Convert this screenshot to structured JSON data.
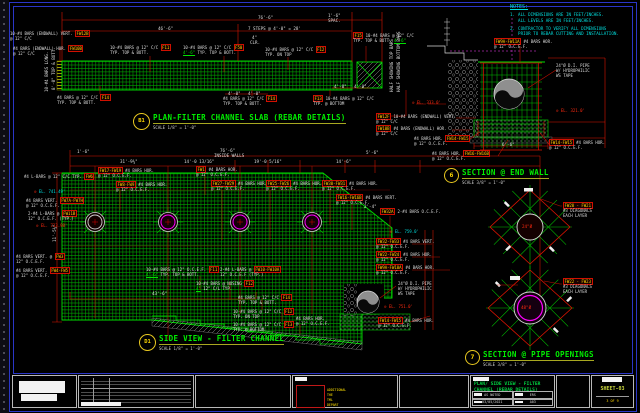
{
  "colors": {
    "dim_red": "#dd1400",
    "rebar_green": "#00b400",
    "title_green": "#00ef00",
    "note_cyan": "#00dcdc",
    "tag_yellow": "#ffd700",
    "pipe_magenta": "#ff30ff",
    "frame_blue": "#2a36c8"
  },
  "notes": {
    "title": "NOTES:",
    "items": [
      {
        "num": "1.",
        "lines": [
          "ALL DIMENSIONS ARE IN FEET/INCHES.",
          "ALL LEVELS ARE IN FEET/INCHES."
        ]
      },
      {
        "num": "2.",
        "lines": [
          "CONTRACTOR TO VERIFY ALL DIMENSIONS",
          "PRIOR TO REBAR CUTTING AND INSTALLATION."
        ]
      }
    ]
  },
  "views": {
    "plan": {
      "bubble": "B1",
      "title": "PLAN-FILTER CHANNEL SLAB (REBAR DETAILS)",
      "scale": "SCALE 1/8\" = 1'-0\""
    },
    "side": {
      "bubble": "D1",
      "title": "SIDE VIEW - FILTER CHANNEL",
      "scale": "SCALE 1/8\" = 1'-0\""
    },
    "end_wall": {
      "bubble": "6",
      "title": "SECTION @ END WALL",
      "scale": "SCALE 3/8\" = 1'-0\""
    },
    "pipe_openings": {
      "bubble": "7",
      "title": "SECTION @ PIPE OPENINGS",
      "scale": "SCALE 3/8\" = 1'-0\""
    }
  },
  "titleblock": {
    "drawing_title_line1": "PLAN/ SIDE VIEW - FILTER",
    "drawing_title_line2": "CHANNEL (REBAR DETAILS)",
    "scale": "AS NOTED",
    "drawn_by": "ERS",
    "date": "03/05/2021",
    "dwg_no": "A03",
    "sheet_label": "SHEET-03",
    "sheet_count": "3 OF 9",
    "stamp_lines": [
      "ADDITIONAL",
      "THE",
      "TML",
      "DEPART"
    ]
  },
  "callouts": [
    {
      "x": 10,
      "y": 31,
      "lines": [
        [
          {
            "t": "10-#4 BARS (ENDWALL) VERT. "
          },
          {
            "t": "FW12B",
            "c": "y"
          }
        ],
        [
          {
            "t": "   @ 12\" C/C"
          }
        ]
      ]
    },
    {
      "x": 13,
      "y": 46,
      "lines": [
        [
          {
            "t": "#4 BARS (ENDWALL) HOR. "
          },
          {
            "t": "FW10B",
            "c": "y"
          }
        ],
        [
          {
            "t": "   @ 12\" C/C"
          }
        ]
      ]
    },
    {
      "x": 110,
      "y": 45,
      "lines": [
        [
          {
            "t": "10-#4 BARS @ 12\" C/C "
          },
          {
            "t": "F11",
            "c": "y"
          }
        ],
        [
          {
            "t": "TYP. TOP & BOTT."
          }
        ]
      ]
    },
    {
      "x": 183,
      "y": 45,
      "lines": [
        [
          {
            "t": "10-#4 BARS @ 12\" C/C "
          },
          {
            "t": "F50",
            "c": "y"
          }
        ],
        [
          {
            "t": "4'-6\"",
            "c": "g"
          },
          {
            "t": " TYP. TOP & BOTT."
          }
        ]
      ]
    },
    {
      "x": 265,
      "y": 47,
      "lines": [
        [
          {
            "t": "10-#4 BARS @ 12\" C/C "
          },
          {
            "t": "F12",
            "c": "y"
          }
        ],
        [
          {
            "t": "TYP. ON TOP"
          }
        ]
      ]
    },
    {
      "x": 353,
      "y": 33,
      "lines": [
        [
          {
            "t": "F15",
            "c": "y"
          },
          {
            "t": " 10-#4 BARS @ 12\" C/C"
          }
        ],
        [
          {
            "t": "TYP. TOP & BOTT. "
          },
          {
            "t": "4'-6\"",
            "c": "g"
          }
        ]
      ]
    },
    {
      "x": 57,
      "y": 95,
      "lines": [
        [
          {
            "t": "#4 BARS @ 12\" C/C "
          },
          {
            "t": "F14",
            "c": "y"
          }
        ],
        [
          {
            "t": "TYP. TOP & BOTT."
          }
        ]
      ]
    },
    {
      "x": 223,
      "y": 96,
      "lines": [
        [
          {
            "t": "#4 BARS @ 12\" C/C "
          },
          {
            "t": "F14",
            "c": "y"
          }
        ],
        [
          {
            "t": "TYP. TOP & BOTT."
          }
        ]
      ]
    },
    {
      "x": 313,
      "y": 96,
      "lines": [
        [
          {
            "t": "F13",
            "c": "y"
          },
          {
            "t": " 10-#4 BARS @ 12\" C/C"
          }
        ],
        [
          {
            "t": "TYP. @ BOTTOM"
          }
        ]
      ]
    },
    {
      "x": 494,
      "y": 39,
      "lines": [
        [
          {
            "t": "FW9A-FW11A",
            "c": "y"
          },
          {
            "t": " #4 BARS HOR."
          }
        ],
        [
          {
            "t": "   @ 12\" O.C.E.F."
          }
        ]
      ]
    },
    {
      "x": 556,
      "y": 63,
      "lines": [
        [
          {
            "t": "24\"Ø D.I. PIPE"
          }
        ],
        [
          {
            "t": "W/ HYDROPHILIC"
          }
        ],
        [
          {
            "t": "WS TAPE"
          }
        ]
      ]
    },
    {
      "x": 412,
      "y": 100,
      "lines": [
        [
          {
            "t": "⊙ ",
            "c": "r"
          },
          {
            "t": "EL. 333.0'",
            "c": "r"
          }
        ]
      ]
    },
    {
      "x": 556,
      "y": 108,
      "lines": [
        [
          {
            "t": "⊙ ",
            "c": "r"
          },
          {
            "t": "EL. 321.0'",
            "c": "r"
          }
        ]
      ]
    },
    {
      "x": 376,
      "y": 114,
      "lines": [
        [
          {
            "t": "FW12F",
            "c": "y"
          },
          {
            "t": " 10-#4 BARS (ENDWALL) VERT."
          }
        ],
        [
          {
            "t": "   @ 12\" C/C"
          }
        ]
      ]
    },
    {
      "x": 376,
      "y": 126,
      "lines": [
        [
          {
            "t": "FW10B",
            "c": "y"
          },
          {
            "t": " #4 BARS (ENDWALL) HOR."
          }
        ],
        [
          {
            "t": "   @ 12\" C/C"
          }
        ]
      ]
    },
    {
      "x": 414,
      "y": 136,
      "lines": [
        [
          {
            "t": "#4 BARS HOR. "
          },
          {
            "t": "FW14-FW15",
            "c": "y"
          }
        ],
        [
          {
            "t": "@ 12\" O.C.E.F."
          }
        ]
      ]
    },
    {
      "x": 432,
      "y": 151,
      "lines": [
        [
          {
            "t": "#4 BARS HOR. "
          },
          {
            "t": "FW16-FW16B",
            "c": "y"
          }
        ],
        [
          {
            "t": "@ 12\" O.C.E.F."
          }
        ]
      ]
    },
    {
      "x": 549,
      "y": 140,
      "lines": [
        [
          {
            "t": "FW14-FW15",
            "c": "y"
          },
          {
            "t": " #4 BARS HOR."
          }
        ],
        [
          {
            "t": "   @ 12\" O.C.E.F."
          }
        ]
      ]
    },
    {
      "x": 24,
      "y": 174,
      "lines": [
        [
          {
            "t": "#4 L-BARS @ 12\" C/C TYP. "
          },
          {
            "t": "FW6",
            "c": "y"
          }
        ]
      ]
    },
    {
      "x": 34,
      "y": 189,
      "lines": [
        [
          {
            "t": "⊙",
            "c": "r"
          },
          {
            "t": " EL. 741.49'",
            "c": "c"
          }
        ]
      ]
    },
    {
      "x": 26,
      "y": 198,
      "lines": [
        [
          {
            "t": "#4 BARS VERT. "
          },
          {
            "t": "FW7A-FW7H",
            "c": "y"
          }
        ],
        [
          {
            "t": "@ 12\" O.C.E.F."
          }
        ]
      ]
    },
    {
      "x": 28,
      "y": 211,
      "lines": [
        [
          {
            "t": "2-#4 L-BARS @ "
          },
          {
            "t": "FW11B",
            "c": "y"
          }
        ],
        [
          {
            "t": "12\" O.C.E.F. (TYP.)"
          }
        ]
      ]
    },
    {
      "x": 36,
      "y": 223,
      "lines": [
        [
          {
            "t": "⊙",
            "c": "r"
          },
          {
            "t": " EL. 733.98'",
            "c": "r"
          }
        ]
      ]
    },
    {
      "x": 16,
      "y": 254,
      "lines": [
        [
          {
            "t": "#4 BARS VERT. @ "
          },
          {
            "t": "FW3",
            "c": "y"
          }
        ],
        [
          {
            "t": "12\" O.C.E.F."
          }
        ]
      ]
    },
    {
      "x": 16,
      "y": 268,
      "lines": [
        [
          {
            "t": "#4 BARS VERT. "
          },
          {
            "t": "FW4-FW5",
            "c": "y"
          }
        ],
        [
          {
            "t": "@ 12\" O.C.E.F."
          }
        ]
      ]
    },
    {
      "x": 98,
      "y": 168,
      "lines": [
        [
          {
            "t": "FW17-FW19",
            "c": "y"
          },
          {
            "t": " #4 BARS HOR."
          }
        ],
        [
          {
            "t": "   @ 12\" O.C.E.F."
          }
        ]
      ]
    },
    {
      "x": 116,
      "y": 182,
      "lines": [
        [
          {
            "t": "FW8-FW9",
            "c": "y"
          },
          {
            "t": " #4 BARS HOR."
          }
        ],
        [
          {
            "t": "   @ 12\" O.C.E.F."
          }
        ]
      ]
    },
    {
      "x": 196,
      "y": 167,
      "lines": [
        [
          {
            "t": "FW1",
            "c": "y"
          },
          {
            "t": " #4 BARS HOR."
          }
        ],
        [
          {
            "t": "   @ 12\" O.C.E.F."
          }
        ]
      ]
    },
    {
      "x": 211,
      "y": 181,
      "lines": [
        [
          {
            "t": "FW27-FW29",
            "c": "y"
          },
          {
            "t": " #4 BARS HOR."
          }
        ],
        [
          {
            "t": "   @ 12\" O.C.E.F."
          }
        ]
      ]
    },
    {
      "x": 266,
      "y": 181,
      "lines": [
        [
          {
            "t": "FW25-FW26",
            "c": "y"
          },
          {
            "t": " #4 BARS HOR."
          }
        ],
        [
          {
            "t": "   @ 12\" O.C.E.F."
          }
        ]
      ]
    },
    {
      "x": 322,
      "y": 181,
      "lines": [
        [
          {
            "t": "FW30-FW31",
            "c": "y"
          },
          {
            "t": " #4 BARS HOR."
          }
        ],
        [
          {
            "t": "   @ 12\" O.C.E.F."
          }
        ]
      ]
    },
    {
      "x": 336,
      "y": 195,
      "lines": [
        [
          {
            "t": "FW16-FW16B",
            "c": "y"
          },
          {
            "t": " #4 BARS VERT."
          }
        ],
        [
          {
            "t": "   @ 12\" O.C.E.F."
          }
        ]
      ]
    },
    {
      "x": 380,
      "y": 209,
      "lines": [
        [
          {
            "t": "FW32A",
            "c": "y"
          },
          {
            "t": " 2-#4 BARS O.C.E.F."
          }
        ]
      ]
    },
    {
      "x": 390,
      "y": 229,
      "lines": [
        [
          {
            "t": "⊙",
            "c": "r"
          },
          {
            "t": " EL. 759.0'",
            "c": "c"
          }
        ]
      ]
    },
    {
      "x": 376,
      "y": 239,
      "lines": [
        [
          {
            "t": "FW32-FW33",
            "c": "y"
          },
          {
            "t": " #4 BARS VERT."
          }
        ],
        [
          {
            "t": "   @ 12\" O.C.E.F."
          }
        ]
      ]
    },
    {
      "x": 376,
      "y": 252,
      "lines": [
        [
          {
            "t": "FW22-FW24",
            "c": "y"
          },
          {
            "t": " #4 BARS HOR."
          }
        ],
        [
          {
            "t": "   @ 12\" O.C.E.F."
          }
        ]
      ]
    },
    {
      "x": 376,
      "y": 265,
      "lines": [
        [
          {
            "t": "FW9A-FW10A",
            "c": "y"
          },
          {
            "t": " #4 BARS HOR."
          }
        ],
        [
          {
            "t": "   @ 12\" O.C.E.F."
          }
        ]
      ]
    },
    {
      "x": 398,
      "y": 281,
      "lines": [
        [
          {
            "t": "24\"Ø D.I. PIPE"
          }
        ],
        [
          {
            "t": "W/ HYDROPHILIC"
          }
        ],
        [
          {
            "t": "WS TAPE"
          }
        ]
      ]
    },
    {
      "x": 384,
      "y": 304,
      "lines": [
        [
          {
            "t": "⊙",
            "c": "r"
          },
          {
            "t": " EL. 751.0'",
            "c": "r"
          }
        ]
      ]
    },
    {
      "x": 378,
      "y": 318,
      "lines": [
        [
          {
            "t": "FW14-FW15",
            "c": "y"
          },
          {
            "t": " #4 BARS HOR."
          }
        ],
        [
          {
            "t": "   @ 12\" O.C.E.F."
          }
        ]
      ]
    },
    {
      "x": 146,
      "y": 267,
      "lines": [
        [
          {
            "t": "10-#4 BARS @ 12\" O.C.E.F. "
          },
          {
            "t": "F11",
            "c": "y"
          }
        ],
        [
          {
            "t": "4'-6\"",
            "c": "g"
          },
          {
            "t": " TYP. TOP & BOTT."
          }
        ]
      ]
    },
    {
      "x": 220,
      "y": 267,
      "lines": [
        [
          {
            "t": "2-#4 L-BARS @ "
          },
          {
            "t": "FW10-FW10A",
            "c": "y"
          }
        ],
        [
          {
            "t": "12\" O.C.E.F (TYP.)"
          }
        ]
      ]
    },
    {
      "x": 196,
      "y": 281,
      "lines": [
        [
          {
            "t": "10-#4 BARS @ NOSING "
          },
          {
            "t": "F12",
            "c": "y"
          }
        ],
        [
          {
            "t": "4\"",
            "c": "g"
          },
          {
            "t": " 12\" C/L TYP."
          }
        ]
      ]
    },
    {
      "x": 238,
      "y": 295,
      "lines": [
        [
          {
            "t": "#4 BARS @ 12\" C/C "
          },
          {
            "t": "F14",
            "c": "y"
          }
        ],
        [
          {
            "t": "TYP. TOP & BOTT."
          }
        ]
      ]
    },
    {
      "x": 233,
      "y": 309,
      "lines": [
        [
          {
            "t": "10-#4 BARS @ 12\" C/C "
          },
          {
            "t": "F12",
            "c": "y"
          }
        ],
        [
          {
            "t": "TYP. ON TOP"
          }
        ]
      ]
    },
    {
      "x": 233,
      "y": 322,
      "lines": [
        [
          {
            "t": "10-#4 BARS @ 12\" C/C "
          },
          {
            "t": "F13",
            "c": "y"
          }
        ],
        [
          {
            "t": "TYP. @ BOTTOM"
          }
        ]
      ]
    },
    {
      "x": 296,
      "y": 316,
      "lines": [
        [
          {
            "t": "#4 BARS HOR."
          }
        ],
        [
          {
            "t": "@ 12\" O.C.E.F."
          }
        ]
      ]
    },
    {
      "x": 563,
      "y": 203,
      "lines": [
        [
          {
            "t": "FW20 - FW21",
            "c": "y"
          }
        ],
        [
          {
            "t": "#3 DIAGONALS"
          }
        ],
        [
          {
            "t": "EACH LAYER"
          }
        ]
      ]
    },
    {
      "x": 563,
      "y": 279,
      "lines": [
        [
          {
            "t": "FW22 - FW23",
            "c": "y"
          }
        ],
        [
          {
            "t": "#3 DIAGONALS"
          }
        ],
        [
          {
            "t": "EACH LAYER"
          }
        ]
      ]
    }
  ],
  "dims": [
    {
      "x": 258,
      "y": 15,
      "t": "76'-6\""
    },
    {
      "x": 158,
      "y": 26,
      "t": "46'-6\""
    },
    {
      "x": 248,
      "y": 26,
      "t": "7 STEPS @ 4'-0\" = 28'"
    },
    {
      "x": 328,
      "y": 13,
      "t": "1'-6\""
    },
    {
      "x": 328,
      "y": 18,
      "t": "SPAC."
    },
    {
      "x": 252,
      "y": 35,
      "t": "4\""
    },
    {
      "x": 250,
      "y": 40,
      "t": "CLR."
    },
    {
      "x": 228,
      "y": 91,
      "t": "4'-0\""
    },
    {
      "x": 248,
      "y": 91,
      "t": "4'-0\""
    },
    {
      "x": 334,
      "y": 84,
      "t": "4'-0\""
    },
    {
      "x": 354,
      "y": 84,
      "t": "4'-0\""
    },
    {
      "x": 44,
      "y": 92,
      "rot": -90,
      "t": "10-#4 BARS LONG."
    },
    {
      "x": 51,
      "y": 90,
      "rot": -90,
      "t": "8'-0\" TOP & BOTT."
    },
    {
      "x": 389,
      "y": 92,
      "rot": -90,
      "t": "HALF SHOWING TOP BARS"
    },
    {
      "x": 396,
      "y": 92,
      "rot": -90,
      "t": "HALF SHOWING BOTTOM BARS"
    },
    {
      "x": 220,
      "y": 148,
      "t": "76'-6\""
    },
    {
      "x": 214,
      "y": 153,
      "t": "INSIDE WALLS"
    },
    {
      "x": 77,
      "y": 149,
      "t": "1'-6\""
    },
    {
      "x": 120,
      "y": 159,
      "t": "31'-9¾\""
    },
    {
      "x": 184,
      "y": 159,
      "t": "14'-0 13/16\""
    },
    {
      "x": 254,
      "y": 159,
      "t": "19'-0 5/16\""
    },
    {
      "x": 336,
      "y": 159,
      "t": "14'-6\""
    },
    {
      "x": 366,
      "y": 150,
      "t": "5'-6\""
    },
    {
      "x": 364,
      "y": 204,
      "t": "2'-4\""
    },
    {
      "x": 152,
      "y": 291,
      "t": "43'-6\""
    },
    {
      "x": 52,
      "y": 242,
      "rot": -90,
      "t": "11'-5¾\""
    },
    {
      "x": 502,
      "y": 142,
      "t": "6'-6\""
    },
    {
      "x": 522,
      "y": 224,
      "t": "24\"Ø",
      "c": "r"
    },
    {
      "x": 521,
      "y": 305,
      "t": "48\"Ø",
      "c": "r"
    }
  ]
}
